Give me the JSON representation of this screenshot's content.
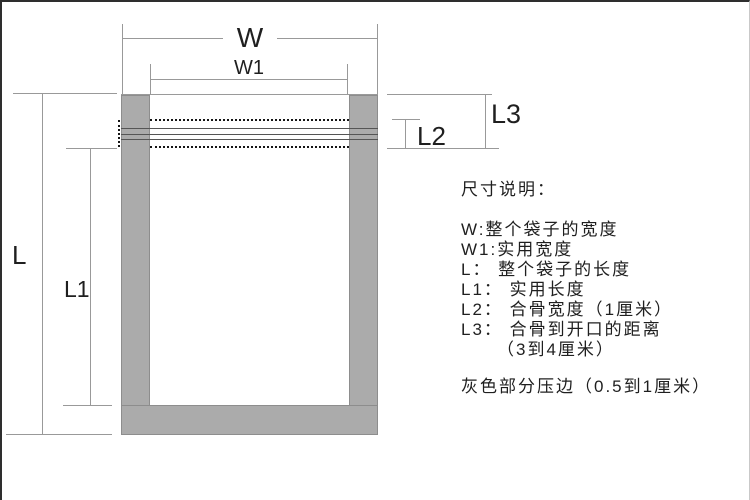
{
  "figure": {
    "dimension_labels": {
      "W": "W",
      "W1": "W1",
      "L": "L",
      "L1": "L1",
      "L2": "L2",
      "L3": "L3"
    },
    "colors": {
      "bag_gray_fill": "#ababab",
      "bag_gray_border": "#8d8d8d",
      "dimension_line": "#999999",
      "seal_line": "#555555",
      "dotted_line": "#151515",
      "text": "#1f1f1f",
      "frame_border": "#2e2e2e"
    }
  },
  "legend": {
    "title": "尺寸说明：",
    "lines": [
      "W:整个袋子的宽度",
      "W1:实用宽度",
      "L： 整个袋子的长度",
      "L1： 实用长度",
      "L2： 合骨宽度（1厘米）",
      "L3： 合骨到开口的距离",
      "（3到4厘米）",
      "灰色部分压边（0.5到1厘米）"
    ]
  }
}
